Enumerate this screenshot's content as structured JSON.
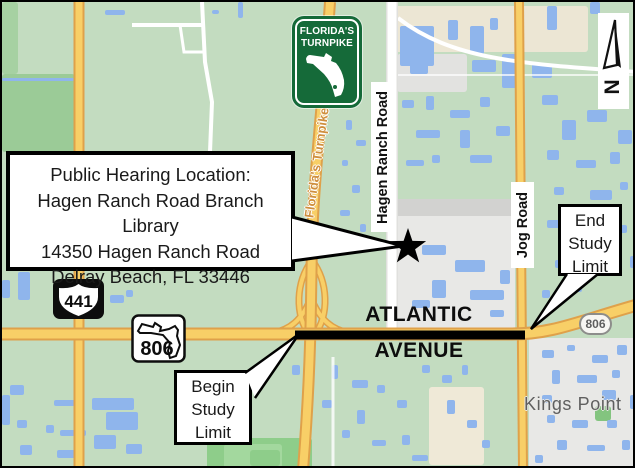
{
  "title": "Public Hearing Location Map",
  "callout": {
    "line1": "Public Hearing Location:",
    "line2": "Hagen Ranch Road Branch Library",
    "line3": "14350 Hagen Ranch Road",
    "line4": "Delray Beach, FL 33446"
  },
  "study_limits": {
    "begin": [
      "Begin",
      "Study",
      "Limit"
    ],
    "end": [
      "End",
      "Study",
      "Limit"
    ]
  },
  "road_labels": {
    "atlantic_word1": "ATLANTIC",
    "atlantic_word2": "AVENUE",
    "hagen_ranch": "Hagen Ranch Road",
    "jog": "Jog Road",
    "turnpike": "Florida's Turnpike",
    "kings_point": "Kings Point"
  },
  "shields": {
    "us441": "441",
    "sr806": "806",
    "sr806_oval": "806",
    "turnpike_name_line1": "FLORIDA'S",
    "turnpike_name_line2": "TURNPIKE"
  },
  "north_arrow": {
    "label": "N"
  },
  "colors": {
    "map_green": "#c3dcc0",
    "dark_green": "#9bcb97",
    "road_yellow": "#f8cf67",
    "road_casing": "#dfa14a",
    "water_blue": "#8fb5ec",
    "urban_gray": "#e8e8e6",
    "beige": "#ece6d4",
    "turnpike_sign_green": "#156a39",
    "turnpike_label_orange": "#cf8f3e",
    "study_line_black": "#000000"
  }
}
